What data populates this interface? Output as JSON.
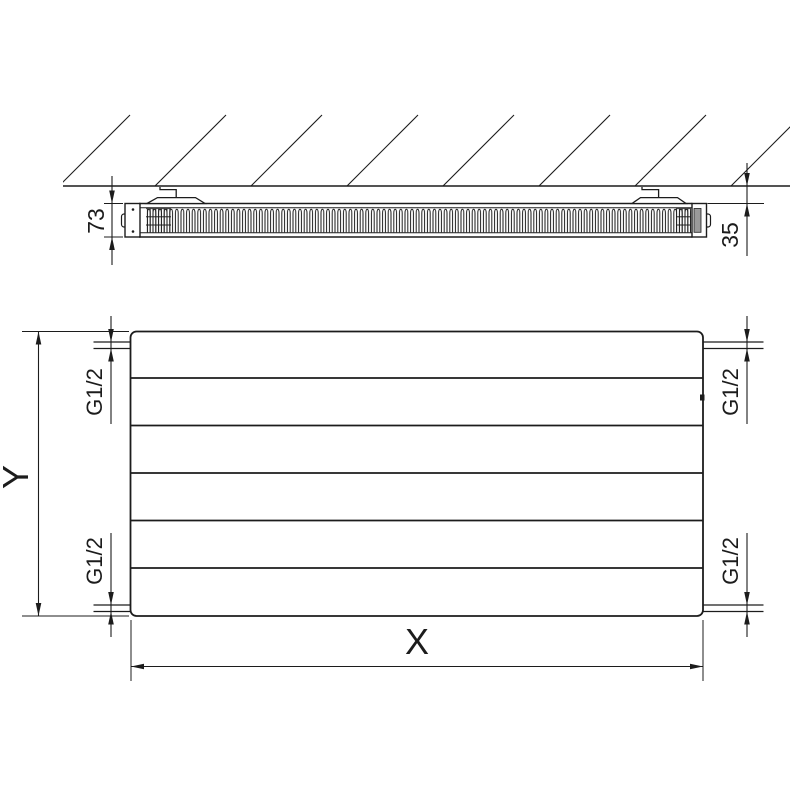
{
  "colors": {
    "background": "#ffffff",
    "line": "#1c1c1c",
    "insert_bar": "#9a9a9a"
  },
  "side_view": {
    "depth_dimension_label": "73",
    "wall_gap_dimension_label": "35"
  },
  "front_view": {
    "height_dimension_label": "Y",
    "width_dimension_label": "X",
    "connections": [
      {
        "position": "top-left",
        "label": "G1/2"
      },
      {
        "position": "top-right",
        "label": "G1/2"
      },
      {
        "position": "bottom-left",
        "label": "G1/2"
      },
      {
        "position": "bottom-right",
        "label": "G1/2"
      }
    ]
  }
}
